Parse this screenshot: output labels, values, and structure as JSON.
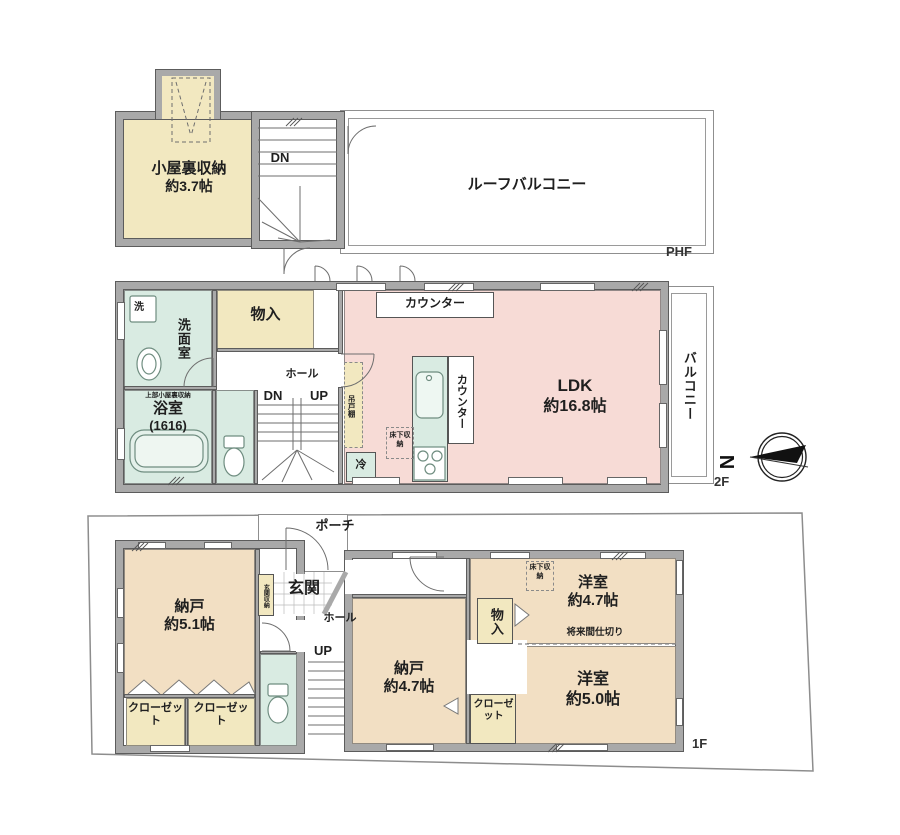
{
  "colors": {
    "wall_gray": "#a9a9a9",
    "room_yellow": "#f2e8c0",
    "room_pink": "#f7dbd6",
    "room_teal": "#d9ebe2",
    "room_tan": "#f2dfc3"
  },
  "compass": {
    "north": "N"
  },
  "floors": {
    "phf": {
      "tag": "PHF",
      "attic": {
        "name": "小屋裏収納",
        "size": "約3.7帖"
      },
      "dn": "DN",
      "roof_balcony": "ルーフバルコニー"
    },
    "f2": {
      "tag": "2F",
      "counter_top": "カウンター",
      "monoire": "物入",
      "washer": "洗",
      "washroom": "洗面室",
      "bath": {
        "note": "上部小屋裏収納",
        "name": "浴室",
        "size": "(1616)"
      },
      "hall": "ホール",
      "dn": "DN",
      "up": "UP",
      "hanging_cupboard": "吊戸棚",
      "fridge": "冷",
      "underfloor_storage": "床下収納",
      "counter_side": "カウンター",
      "ldk": {
        "name": "LDK",
        "size": "約16.8帖"
      },
      "balcony": "バルコニー"
    },
    "f1": {
      "tag": "1F",
      "porch": "ポーチ",
      "entrance": "玄関",
      "entrance_storage": "玄関収納",
      "hall": "ホール",
      "up": "UP",
      "storage_51": {
        "name": "納戸",
        "size": "約5.1帖"
      },
      "closet_a": "クローゼット",
      "closet_b": "クローゼット",
      "closet_mid": "クローゼット",
      "monoire": "物入",
      "underfloor_storage": "床下収納",
      "storage_47": {
        "name": "納戸",
        "size": "約4.7帖"
      },
      "western_47": {
        "name": "洋室",
        "size": "約4.7帖"
      },
      "partition_note": "将来間仕切り",
      "western_50": {
        "name": "洋室",
        "size": "約5.0帖"
      }
    }
  }
}
